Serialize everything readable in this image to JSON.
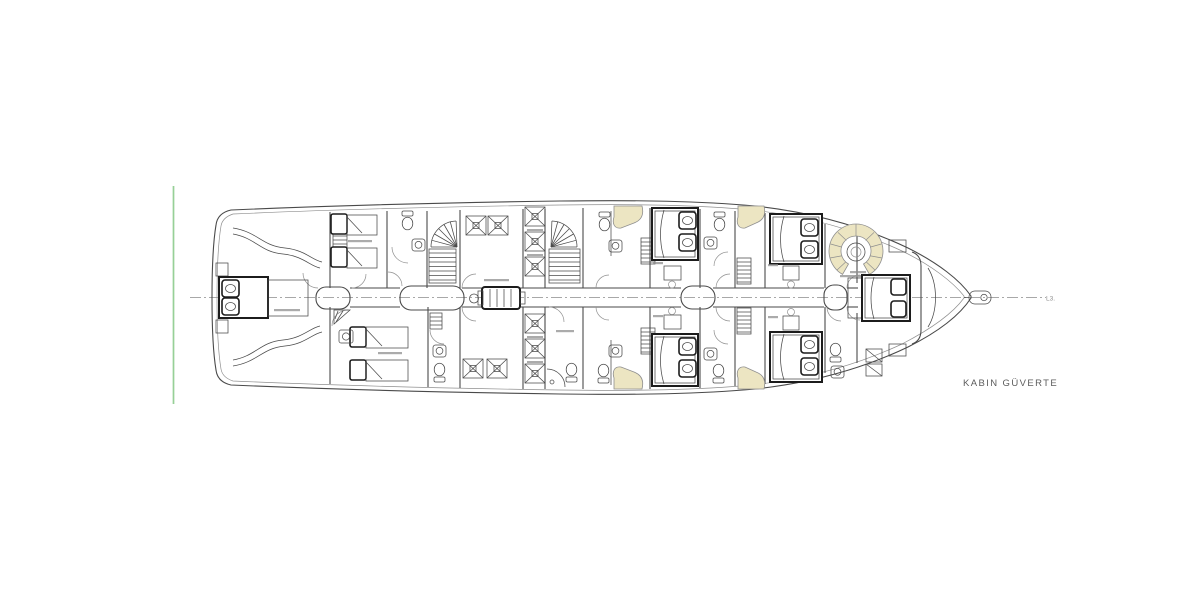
{
  "drawing": {
    "title": "KABIN GÜVERTE",
    "centerline_label": "L3.",
    "colors": {
      "background": "#ffffff",
      "line": "#4a4a4a",
      "bold": "#1c1c1c",
      "light": "#8f8f8f",
      "centerline": "#a8a8a8",
      "cream": "#ece5c2",
      "cream_light": "#f8f4e0",
      "green": "#97d097",
      "label": "#5c5c5c"
    }
  }
}
